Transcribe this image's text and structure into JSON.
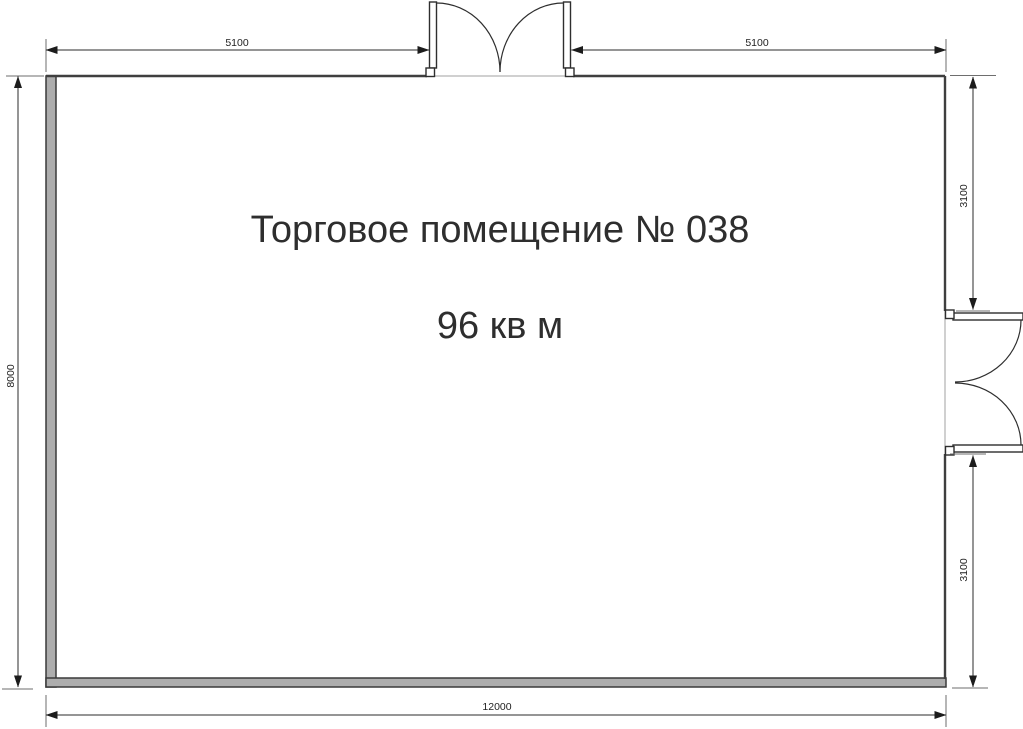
{
  "floor_plan": {
    "title": "Торговое помещение № 038",
    "area": "96 кв м",
    "dimensions": {
      "top_left_width": "5100",
      "top_right_width": "5100",
      "left_height": "8000",
      "right_top_height": "3100",
      "right_bottom_height": "3100",
      "bottom_width": "12000"
    },
    "colors": {
      "wall_fill": "#adadad",
      "hatch_line": "#cdd5cc",
      "hatch_background": "#fcfcfb",
      "dimension_color": "#2b2b2b",
      "label_color": "#2e2e2e"
    }
  }
}
